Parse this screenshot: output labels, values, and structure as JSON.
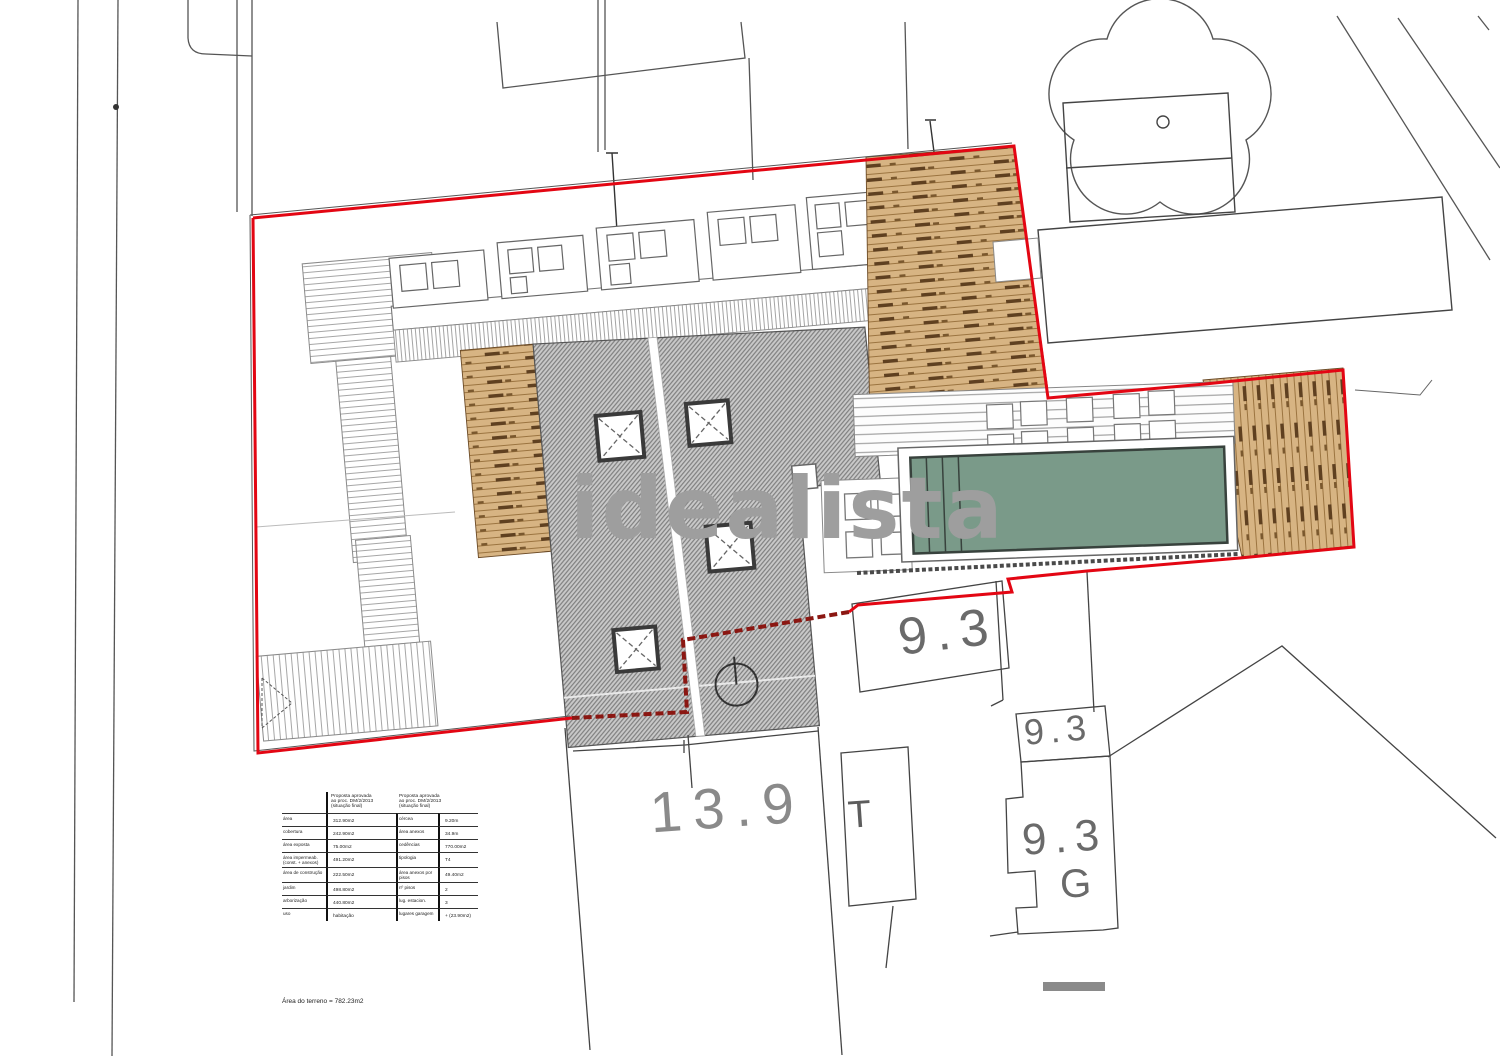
{
  "plan": {
    "watermark": "idealista",
    "labels": {
      "parcel_top": "9.3",
      "parcel_mid": "9.3",
      "parcel_bottom": "9.3",
      "garage": "G",
      "transformer": "T",
      "lot_number": "13.9"
    },
    "table": {
      "header_left": "Proposta aprovada\nao proc. DM/2/2013\n(situação final)",
      "header_right": "Proposta aprovada\nao proc. DM/2/2013\n(situação final)",
      "rows": [
        {
          "c0": "área",
          "c1": "312.90m2",
          "c2": "cércea",
          "c3": "9.20m"
        },
        {
          "c0": "cobertura",
          "c1": "242.90m2",
          "c2": "área anexos",
          "c3": "34.9m"
        },
        {
          "c0": "área exposta",
          "c1": "75.00m2",
          "c2": "cedências",
          "c3": "770.00m2"
        },
        {
          "c0": "área impermeab. (const. + anexos)",
          "c1": "491.20m2",
          "c2": "tipologia",
          "c3": "T4"
        },
        {
          "c0": "área de construção",
          "c1": "222.50m2",
          "c2": "área anexos por pisos",
          "c3": "49.40m2"
        },
        {
          "c0": "jardim",
          "c1": "498.80m2",
          "c2": "nº pisos",
          "c3": "2"
        },
        {
          "c0": "arborização",
          "c1": "440.80m2",
          "c2": "lug. estacion.",
          "c3": "3"
        },
        {
          "c0": "uso",
          "c1": "habitação",
          "c2": "lugares garagem",
          "c3": "+ (23.90m2)"
        }
      ],
      "note": "Área do terreno = 782.23m2"
    },
    "colors": {
      "boundary": "#e30613",
      "division": "#8b1712",
      "pool": "#7a9a89",
      "wood": "#d7b483",
      "roof": "#c9c9c9",
      "watermark": "#9e9e9e"
    }
  }
}
